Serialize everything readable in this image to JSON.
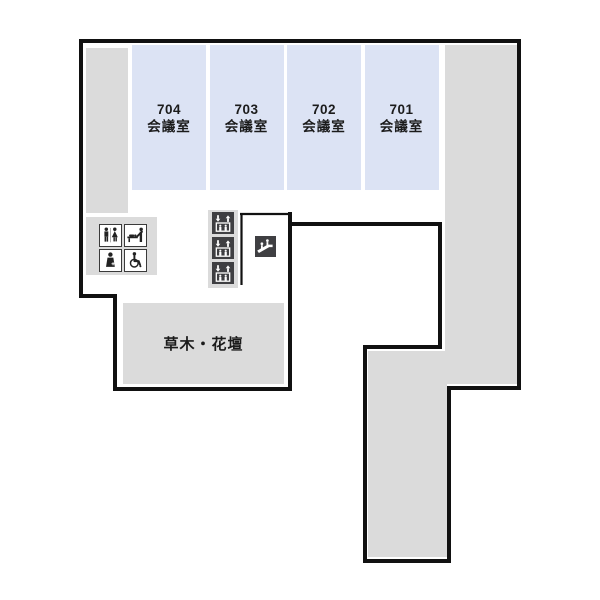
{
  "floor_map": {
    "rooms": [
      {
        "number": "704",
        "type": "会議室"
      },
      {
        "number": "703",
        "type": "会議室"
      },
      {
        "number": "702",
        "type": "会議室"
      },
      {
        "number": "701",
        "type": "会議室"
      }
    ],
    "areas": {
      "garden_label": "草木・花壇"
    },
    "icons": {
      "restroom": "restroom-icon",
      "baby_changing": "baby-changing-icon",
      "baby_chair": "baby-chair-icon",
      "wheelchair": "wheelchair-accessible-icon",
      "elevator": "elevator-icon",
      "elevator_count": 3,
      "escalator": "escalator-icon"
    },
    "colors": {
      "wall": "#111111",
      "corridor_fill": "#dbdbdb",
      "room_fill": "#dce3f4",
      "icon_dark": "#3f3f42"
    }
  }
}
